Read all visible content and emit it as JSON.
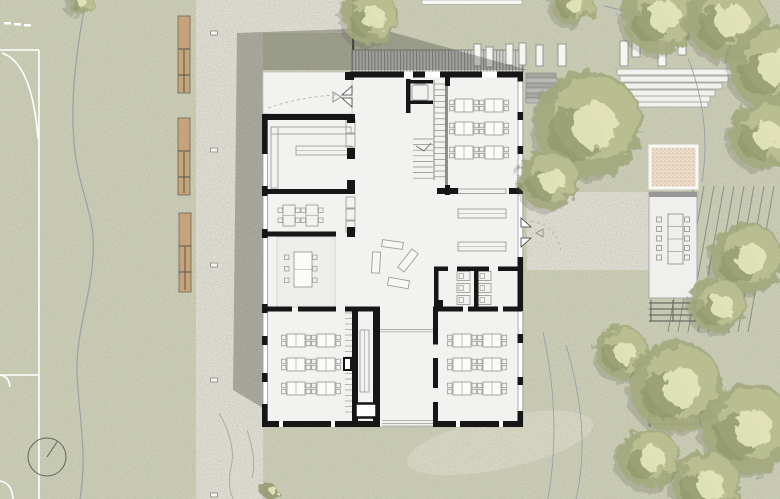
{
  "app": {
    "title": "architectural-site-plan",
    "description": "ground floor plan of a school building with landscaped site"
  },
  "palette": {
    "grass": "#d2d4bc",
    "path": "#eae7e0",
    "worn": "#e1e0ce",
    "grain": "#5d6047",
    "court_line": "#ffffff",
    "bench_fill": "#c7a379",
    "bench_stroke": "#6f6f67",
    "shadow": "rgba(66,66,60,0.34)",
    "deck_bg": "#cfcecb",
    "deck_line": "#8e8e8a",
    "floor": "#f2f2f0",
    "wall": "#161616",
    "furn": "#9d9d98",
    "thin": "#bdbdb8",
    "plank_fill": "#f5f5f2",
    "plank_stroke": "#8f8f8a",
    "step_fill": "#f2f1ed",
    "step_stroke": "#a8a8a2",
    "stair_a": "#b9b9b5",
    "stair_b": "#a5a5a1",
    "pavilion": "#efefed",
    "pavilion_top": "#97979a",
    "sand": "#eddcca",
    "sand_dot": "#c9a189",
    "sand_border": "#f8f8f5",
    "pergola": "#6d6d68",
    "vineyard": "#8b8e84",
    "contour": "#9aa0a8",
    "tree_shadow": "#5a604a",
    "tree_base": "#a3a97e",
    "tree_mid": "#bcc194",
    "tree_dark": "#8e9569",
    "tree_hi": "#e6e7bd",
    "white_bar": "#f7f7f4",
    "courtyard_line": "#4a4a46"
  },
  "canvas": {
    "w": 780,
    "h": 499
  },
  "ground": {
    "paths": [
      [
        196,
        0,
        67,
        499
      ],
      [
        196,
        0,
        156,
        33
      ],
      [
        527,
        192,
        122,
        78
      ]
    ],
    "worn": {
      "cx": 500,
      "cy": 443,
      "rx": 95,
      "ry": 26,
      "rot": -12
    }
  },
  "court": {
    "lines": [
      [
        39,
        50,
        39,
        499
      ],
      [
        0,
        50,
        39,
        50
      ],
      [
        0,
        375,
        39,
        375
      ]
    ],
    "arcs": [
      "M2,53 Q32,63 38,138",
      "M0,375 q9,1 10,12",
      "M0,481 q12,2 13,18"
    ],
    "dashes": [
      [
        4,
        22
      ],
      [
        14,
        23
      ],
      [
        24,
        24
      ]
    ],
    "circle": [
      47,
      457,
      19
    ],
    "hand": [
      47,
      457,
      57,
      442
    ]
  },
  "site": {
    "west_path_line": "M86,0 C78,40 70,95 74,142 C78,192 96,212 93,256 C90,302 76,332 77,372 C78,412 88,452 80,499",
    "track_curves": [
      "M219,413 q18,32 12,54 q-4,18 2,32",
      "M247,430 q10,30 5,48"
    ],
    "benches": [
      {
        "r": [
          178,
          16,
          12,
          77
        ],
        "lines": [
          49,
          75
        ],
        "vline": [
          184,
          50,
          92
        ]
      },
      {
        "r": [
          178,
          118,
          12,
          77
        ],
        "lines": [
          151,
          177
        ],
        "vline": [
          184,
          152,
          193
        ]
      },
      {
        "r": [
          179,
          213,
          12,
          79
        ],
        "lines": [
          246,
          272
        ],
        "vline": [
          185,
          247,
          290
        ]
      }
    ],
    "bollards": [
      [
        214,
        33
      ],
      [
        214,
        150
      ],
      [
        214,
        265
      ],
      [
        214,
        380
      ],
      [
        214,
        495
      ]
    ],
    "deck": [
      352,
      50,
      171,
      22
    ],
    "courtyard_line": [
      352,
      0,
      2.2,
      52
    ],
    "white_bar": [
      422,
      0,
      100,
      4.5
    ],
    "ne_stairs": {
      "x": 526,
      "y0": 73,
      "dy": 5,
      "n": 6,
      "w0": 30,
      "dw": 1.5
    },
    "amphitheater": [
      [
        617,
        69,
        117,
        6
      ],
      [
        620,
        76,
        108,
        6
      ],
      [
        624,
        83,
        98,
        6
      ],
      [
        628,
        90,
        87,
        6
      ],
      [
        631,
        96,
        79,
        6
      ],
      [
        634,
        102,
        74,
        5
      ]
    ],
    "planks": [
      [
        474,
        44,
        7,
        22
      ],
      [
        486,
        47,
        7,
        20
      ],
      [
        506,
        44,
        7,
        21
      ],
      [
        519,
        43,
        7,
        22
      ],
      [
        536,
        45,
        7,
        21
      ],
      [
        558,
        44,
        8,
        22
      ],
      [
        620,
        41,
        8,
        25
      ],
      [
        632,
        31,
        8,
        26
      ],
      [
        658,
        41,
        8,
        25
      ],
      [
        678,
        31,
        8,
        24
      ]
    ],
    "vineyard": {
      "x0": 694,
      "dx": 10,
      "n": 9,
      "y1": 186,
      "y2": 332,
      "lean": -26
    },
    "contours": [
      "M604,6 Q690,26 780,30",
      "M616,14 Q700,40 780,46",
      "M688,58 Q712,120 702,182",
      "M543,332 Q562,420 548,499",
      "M566,345 Q592,432 576,499"
    ],
    "sprout": [
      269,
      491,
      8
    ]
  },
  "shadow": {
    "points": "233,390 237,33 377,28 528,70 263,70 263,408"
  },
  "sandbox": {
    "rect": [
      650,
      146,
      47,
      42
    ]
  },
  "pavilion": {
    "floor": [
      649,
      192,
      48,
      106
    ],
    "top_bar": [
      649,
      192,
      48,
      5
    ],
    "table": [
      668,
      214,
      15,
      50
    ],
    "chair": 5,
    "chairs_left_x": 661.5,
    "chairs_right_x": 684.5,
    "chairs_y0": 217,
    "chairs_dy": 9.5,
    "chairs_n": 5
  },
  "pergolas": [
    {
      "frame": [
        649,
        300,
        48,
        22
      ],
      "lines": [
        303,
        309,
        315,
        321
      ],
      "posts": [
        651,
        673,
        695
      ]
    },
    {
      "frame": [
        648,
        397,
        50,
        30
      ],
      "lines": [
        400,
        408,
        416,
        424
      ],
      "posts": [
        650,
        672,
        696
      ]
    }
  ],
  "trees": [
    [
      80,
      1,
      13
    ],
    [
      573,
      3,
      22
    ],
    [
      660,
      16,
      38
    ],
    [
      727,
      20,
      40
    ],
    [
      771,
      66,
      42
    ],
    [
      764,
      135,
      34
    ],
    [
      370,
      17,
      28
    ],
    [
      588,
      124,
      54
    ],
    [
      549,
      180,
      30
    ],
    [
      747,
      258,
      36
    ],
    [
      718,
      305,
      28
    ],
    [
      622,
      352,
      26
    ],
    [
      676,
      386,
      46
    ],
    [
      748,
      428,
      46
    ],
    [
      649,
      458,
      30
    ],
    [
      706,
      484,
      34
    ]
  ],
  "building": {
    "floor_points": "352,72 523,72 523,427 263,427 263,114 352,114",
    "porch": [
      263,
      72,
      89,
      42
    ],
    "glazing": [
      [
        263,
        114,
        4.5,
        307
      ],
      [
        518,
        77,
        4.8,
        344
      ]
    ],
    "walls": [
      [
        350,
        71.5,
        173,
        6
      ],
      [
        262,
        421,
        118,
        6
      ],
      [
        433,
        421,
        90,
        6
      ],
      [
        262,
        114,
        5.5,
        40
      ],
      [
        262,
        186,
        5.5,
        10
      ],
      [
        262,
        229,
        5.5,
        9
      ],
      [
        262,
        304,
        5.5,
        9
      ],
      [
        262,
        336,
        5.5,
        9
      ],
      [
        262,
        373,
        5.5,
        9
      ],
      [
        262,
        404,
        5.5,
        23
      ],
      [
        517.5,
        71.5,
        5.5,
        10
      ],
      [
        517.5,
        112,
        5.5,
        8
      ],
      [
        517.5,
        146,
        5.5,
        8
      ],
      [
        517.5,
        183,
        5.5,
        11
      ],
      [
        517.5,
        257,
        5.5,
        11
      ],
      [
        517.5,
        267,
        5.5,
        44
      ],
      [
        517.5,
        334,
        5.5,
        9
      ],
      [
        517.5,
        377,
        5.5,
        8
      ],
      [
        517.5,
        411,
        5.5,
        16
      ],
      [
        262,
        114,
        93,
        6
      ],
      [
        262,
        189,
        93,
        5
      ],
      [
        347,
        114,
        8,
        9
      ],
      [
        347,
        148,
        8,
        11
      ],
      [
        347,
        180,
        8,
        10
      ],
      [
        347,
        227,
        8,
        10
      ],
      [
        262,
        231.5,
        74,
        5
      ],
      [
        266,
        306.5,
        26,
        5
      ],
      [
        298,
        306.5,
        38,
        5
      ],
      [
        345,
        306.5,
        35,
        5
      ],
      [
        352,
        311,
        6,
        110
      ],
      [
        373,
        309,
        7,
        112
      ],
      [
        406,
        79,
        4.5,
        34
      ],
      [
        407,
        80,
        26,
        3.5
      ],
      [
        407,
        80,
        3.5,
        24
      ],
      [
        407,
        100.5,
        26,
        3.5
      ],
      [
        445,
        77,
        5,
        9
      ],
      [
        445,
        185,
        5,
        10
      ],
      [
        437,
        188,
        21,
        6
      ],
      [
        509,
        188,
        14,
        6
      ],
      [
        434,
        266.5,
        14,
        4.5
      ],
      [
        457,
        266.5,
        32,
        4.5
      ],
      [
        498,
        266.5,
        24,
        4.5
      ],
      [
        434,
        266.5,
        4.5,
        44
      ],
      [
        474,
        266.5,
        4.5,
        44
      ],
      [
        434,
        300,
        9,
        10
      ],
      [
        433,
        306.5,
        30,
        5
      ],
      [
        468,
        306.5,
        30,
        5
      ],
      [
        503,
        306.5,
        19,
        5
      ],
      [
        433,
        306.5,
        5,
        38
      ],
      [
        433,
        358,
        5,
        30
      ],
      [
        433,
        402,
        5,
        25
      ],
      [
        345,
        72,
        9,
        8
      ]
    ],
    "white_gaps": [
      [
        404,
        71.5,
        9,
        6
      ],
      [
        425,
        71.5,
        15,
        6
      ],
      [
        482,
        71.5,
        15,
        6
      ],
      [
        279,
        421,
        4,
        6
      ],
      [
        331,
        421,
        4,
        6
      ],
      [
        456,
        421,
        4,
        6
      ],
      [
        499,
        421,
        4,
        6
      ]
    ],
    "rug": [
      277,
      237,
      58,
      70
    ],
    "recess_lines": [
      [
        380,
        329.5,
        433,
        329.5
      ],
      [
        380,
        331.8,
        433,
        331.8
      ],
      [
        382,
        420.5,
        433,
        420.5
      ],
      [
        382,
        423.5,
        433,
        423.5
      ],
      [
        382,
        426,
        433,
        426
      ]
    ],
    "shaft": [
      355.5,
      403.5,
      21,
      14
    ],
    "black_box": [
      343,
      357,
      9,
      14
    ],
    "kitchen": {
      "counter": [
        [
          271,
          127,
          80,
          7
        ],
        [
          271,
          127,
          7,
          61
        ]
      ],
      "table": [
        296,
        146,
        56,
        9
      ],
      "closets": [
        [
          346,
          120,
          9,
          13
        ],
        [
          346,
          134,
          9,
          13
        ],
        [
          346,
          197,
          9,
          11
        ],
        [
          346,
          209,
          9,
          11
        ],
        [
          346,
          221,
          9,
          11
        ]
      ]
    },
    "room2_tables": [
      [
        283,
        205
      ],
      [
        306,
        205
      ]
    ],
    "meeting_table": {
      "rect": [
        294,
        252,
        18,
        35
      ],
      "chairs_y": [
        255,
        266.5,
        278
      ],
      "left_x": 289,
      "right_x": 312.5
    },
    "classrooms": {
      "tw": 18,
      "th": 13,
      "chair": 4.5,
      "groups": [
        [
          455,
          99
        ],
        [
          485,
          99
        ],
        [
          455,
          122
        ],
        [
          485,
          122
        ],
        [
          455,
          146
        ],
        [
          485,
          146
        ],
        [
          287,
          334
        ],
        [
          317,
          334
        ],
        [
          287,
          358
        ],
        [
          317,
          358
        ],
        [
          287,
          382
        ],
        [
          317,
          382
        ],
        [
          453,
          334
        ],
        [
          483,
          334
        ],
        [
          453,
          358
        ],
        [
          483,
          358
        ],
        [
          453,
          382
        ],
        [
          483,
          382
        ]
      ]
    },
    "counter_tr": [
      458,
      189,
      48,
      4.5
    ],
    "shelves": [
      [
        458,
        209,
        48,
        9
      ],
      [
        458,
        242,
        48,
        9
      ]
    ],
    "narrow_table": [
      360,
      330,
      9,
      62
    ],
    "corridor_treads": {
      "x1": 345,
      "x2": 352,
      "y0": 313,
      "dy": 5.5,
      "n": 19
    },
    "stair": {
      "run1": {
        "x1": 434,
        "x2": 445.5,
        "y0": 84,
        "dy": 5.8,
        "n": 17,
        "rails": [
          [
            434,
            80,
            434,
            180
          ],
          [
            445.5,
            77,
            445.5,
            187
          ]
        ]
      },
      "run2": {
        "x1": 413,
        "x2": 433,
        "y0": 139,
        "dy": 5.6,
        "n": 8
      },
      "arrow": "416,146 424,151 431,143",
      "core_wall": [
        447,
        77,
        447,
        195
      ]
    },
    "elevator": {
      "inner": [
        412,
        85,
        16,
        15
      ],
      "door": [
        415,
        81,
        10,
        3
      ]
    },
    "toilets": {
      "rooms_x": [
        457,
        478
      ],
      "y0": 271.5,
      "dy": 12,
      "n": 3,
      "w": 13,
      "h": 9
    },
    "hall_benches": [
      [
        382,
        241,
        21,
        7,
        8
      ],
      [
        372,
        252,
        8,
        21,
        3
      ],
      [
        404,
        249,
        8,
        23,
        38
      ],
      [
        388,
        279,
        21,
        8,
        10
      ]
    ],
    "doors": {
      "porch_leaves": [
        [
          [
            352,
            86
          ],
          [
            342,
            95
          ],
          [
            352,
            95
          ]
        ],
        [
          [
            352,
            107
          ],
          [
            342,
            98
          ],
          [
            352,
            98
          ]
        ]
      ],
      "porch_arrow": [
        [
          333,
          92
        ],
        [
          341,
          97
        ],
        [
          333,
          102
        ]
      ],
      "east_leaves": [
        [
          [
            521,
            218
          ],
          [
            531,
            227
          ],
          [
            521,
            227
          ]
        ],
        [
          [
            521,
            247
          ],
          [
            531,
            238
          ],
          [
            521,
            238
          ]
        ]
      ],
      "east_arrow": [
        [
          543,
          229
        ],
        [
          536,
          233
        ],
        [
          543,
          237
        ]
      ],
      "dashed": [
        "M268,108 Q300,97 336,95",
        "M531,221 q26,5 30,30"
      ]
    }
  }
}
